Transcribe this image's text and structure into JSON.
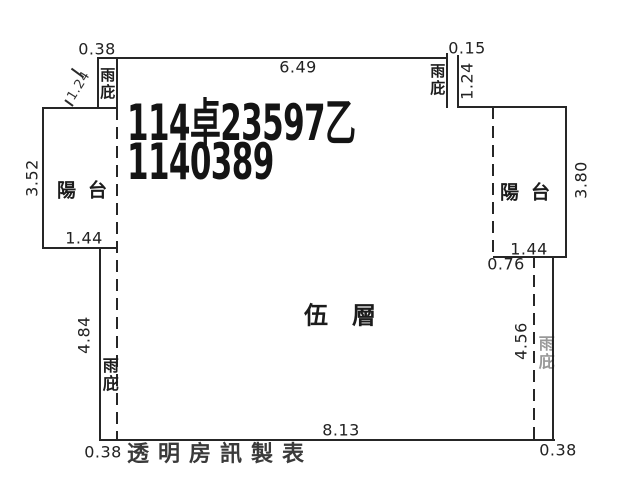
{
  "plan": {
    "title_line1": "114卓23597乙",
    "title_line2": "1140389",
    "floor_label": "伍層",
    "credit": "透明房訊製表",
    "balcony_label": "陽台",
    "canopy_label": "雨庇",
    "dims": {
      "top_left_canopy_width": "0.38",
      "top_width": "6.49",
      "top_right_canopy_width": "0.15",
      "top_left_canopy_note": "1.24",
      "top_right_canopy_height": "1.24",
      "left_balcony_height": "3.52",
      "right_balcony_height": "3.80",
      "left_balcony_width": "1.44",
      "right_balcony_width": "1.44",
      "right_offset": "0.76",
      "left_canopy_length": "4.84",
      "right_canopy_length": "4.56",
      "bottom_width": "8.13",
      "bottom_left_width": "0.38",
      "bottom_right_width": "0.38"
    },
    "colors": {
      "ink": "#262626",
      "paper": "#ffffff"
    }
  }
}
